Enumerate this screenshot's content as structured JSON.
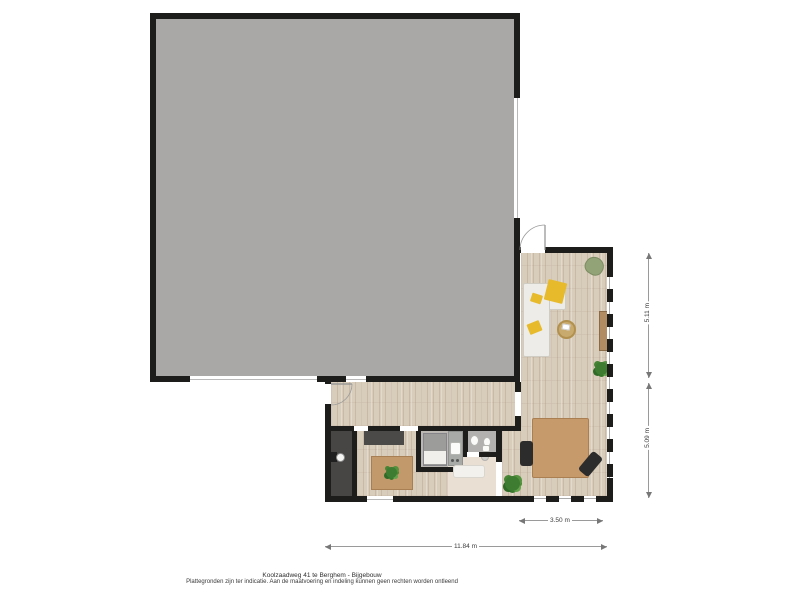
{
  "caption": {
    "line1": "Koolzaadweg 41 te Berghem - Bijgebouw",
    "line2": "Plattegronden zijn ter indicatie. Aan de maatvoering en indeling kunnen geen rechten worden ontleend"
  },
  "dimensions": {
    "right_upper": "5.11 m",
    "right_lower": "5.09 m",
    "bottom_width": "3.50 m",
    "bottom_total": "11.84 m"
  },
  "icons": {
    "boiler": "boiler-icon"
  },
  "colors": {
    "wall": "#1d1d1b",
    "barn_floor": "#a9a8a6",
    "wood_floor": "#d8ccbb",
    "hall_floor": "#e9dfd2",
    "bath_floor": "#b2b1af",
    "tech_floor": "#474645",
    "table_wood": "#c79a6c",
    "accent_yellow": "#e7ba2c",
    "plant_green": "#3e7c31"
  }
}
